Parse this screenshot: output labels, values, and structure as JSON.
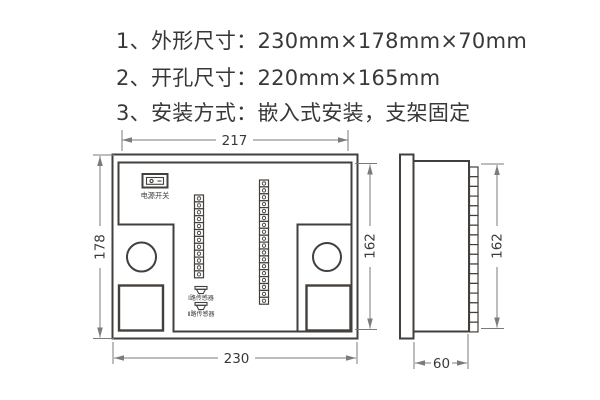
{
  "specs": {
    "items": [
      {
        "text": "1、外形尺寸：230mm×178mm×70mm"
      },
      {
        "text": "2、开孔尺寸：220mm×165mm"
      },
      {
        "text": "3、安装方式：嵌入式安装，支架固定"
      }
    ]
  },
  "rear_view": {
    "dim_top": "217",
    "dim_left": "178",
    "dim_right": "162",
    "dim_bottom": "230",
    "power_switch_label": "电源开关",
    "sensor1_label": "Ⅰ路传感器",
    "sensor2_label": "Ⅱ路传感器",
    "terminal_strip_left_count": 12,
    "terminal_strip_right_count": 18
  },
  "side_view": {
    "dim_height": "162",
    "dim_depth": "60",
    "rib_count": 17
  },
  "colors": {
    "line": "#433f3c",
    "dim_line": "#7b7b7b",
    "text": "#383838"
  }
}
